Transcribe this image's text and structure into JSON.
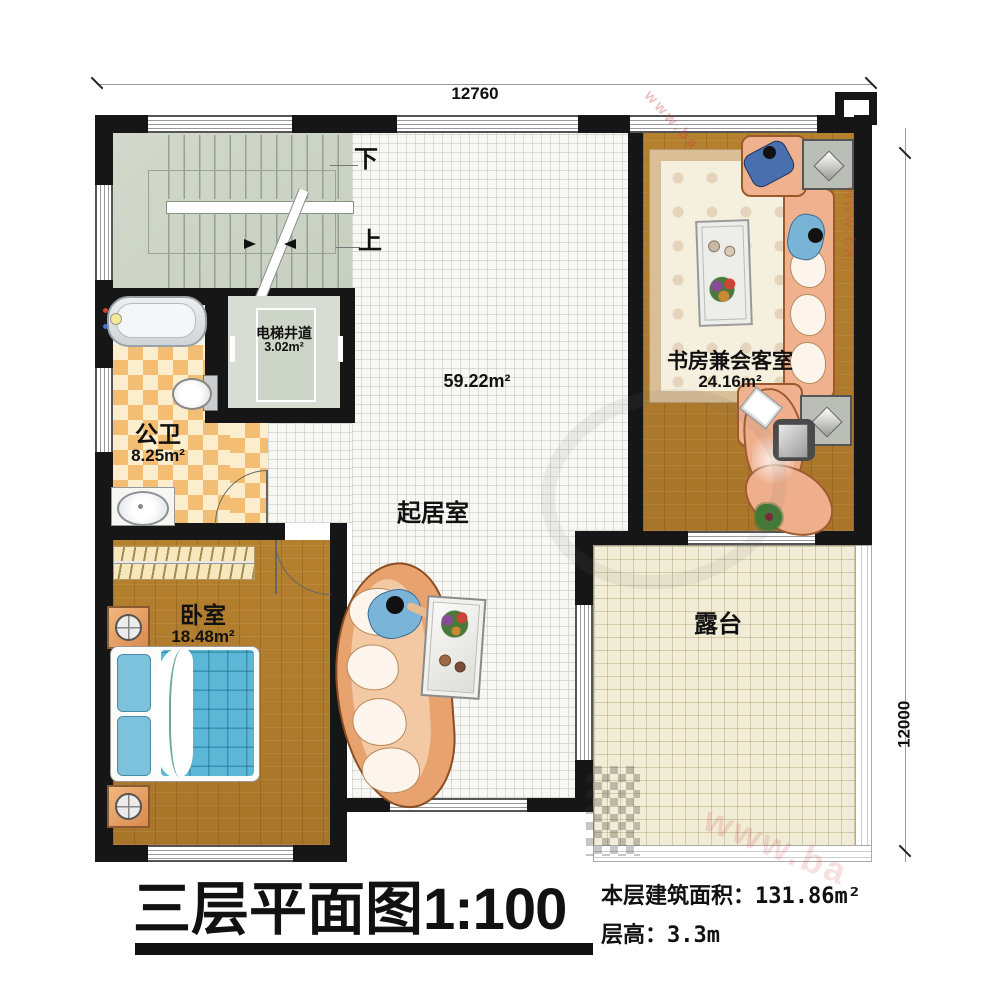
{
  "watermark": {
    "fragment": "www.ba"
  },
  "dimensions": {
    "top": "12760",
    "right": "12000"
  },
  "stairs": {
    "down": "下",
    "up": "上"
  },
  "rooms": {
    "elevator": {
      "name": "电梯井道",
      "area": "3.02m²"
    },
    "bathroom": {
      "name": "公卫",
      "area": "8.25m²"
    },
    "living": {
      "name": "起居室",
      "area": "59.22m²"
    },
    "study": {
      "name": "书房兼会客室",
      "area": "24.16m²"
    },
    "bedroom": {
      "name": "卧室",
      "area": "18.48m²"
    },
    "terrace": {
      "name": "露台"
    }
  },
  "title_block": {
    "title": "三层平面图",
    "scale": "1:100",
    "area_label": "本层建筑面积：",
    "area_value": "131.86m²",
    "height_label": "层高：",
    "height_value": "3.3m"
  }
}
